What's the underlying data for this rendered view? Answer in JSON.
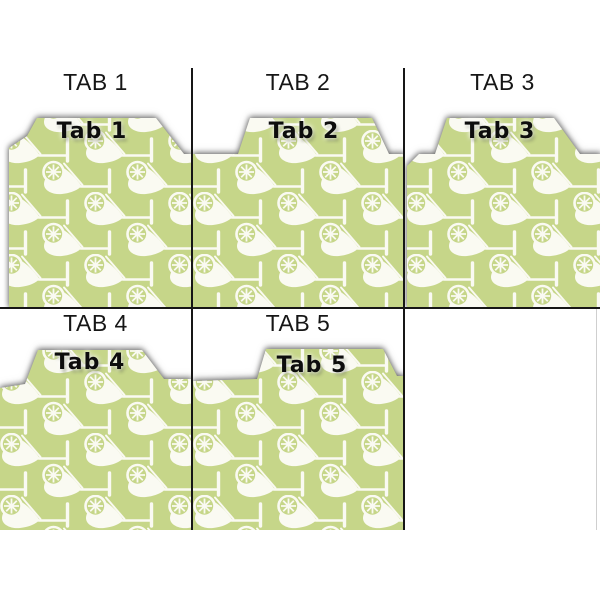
{
  "page": {
    "background_color": "#ffffff",
    "description_colors": {
      "grid_line": "#161616",
      "caption_text": "#161616",
      "tab_label_text": "#0d0d0d"
    }
  },
  "pattern": {
    "name": "margarita-glass-with-lime-wheel",
    "background_color": "#c6d689",
    "motif_color": "#fafaf2"
  },
  "cells": [
    {
      "caption": "TAB 1",
      "tab_label": "Tab 1"
    },
    {
      "caption": "TAB 2",
      "tab_label": "Tab 2"
    },
    {
      "caption": "TAB 3",
      "tab_label": "Tab 3"
    },
    {
      "caption": "TAB 4",
      "tab_label": "Tab 4"
    },
    {
      "caption": "TAB 5",
      "tab_label": "Tab 5"
    }
  ]
}
